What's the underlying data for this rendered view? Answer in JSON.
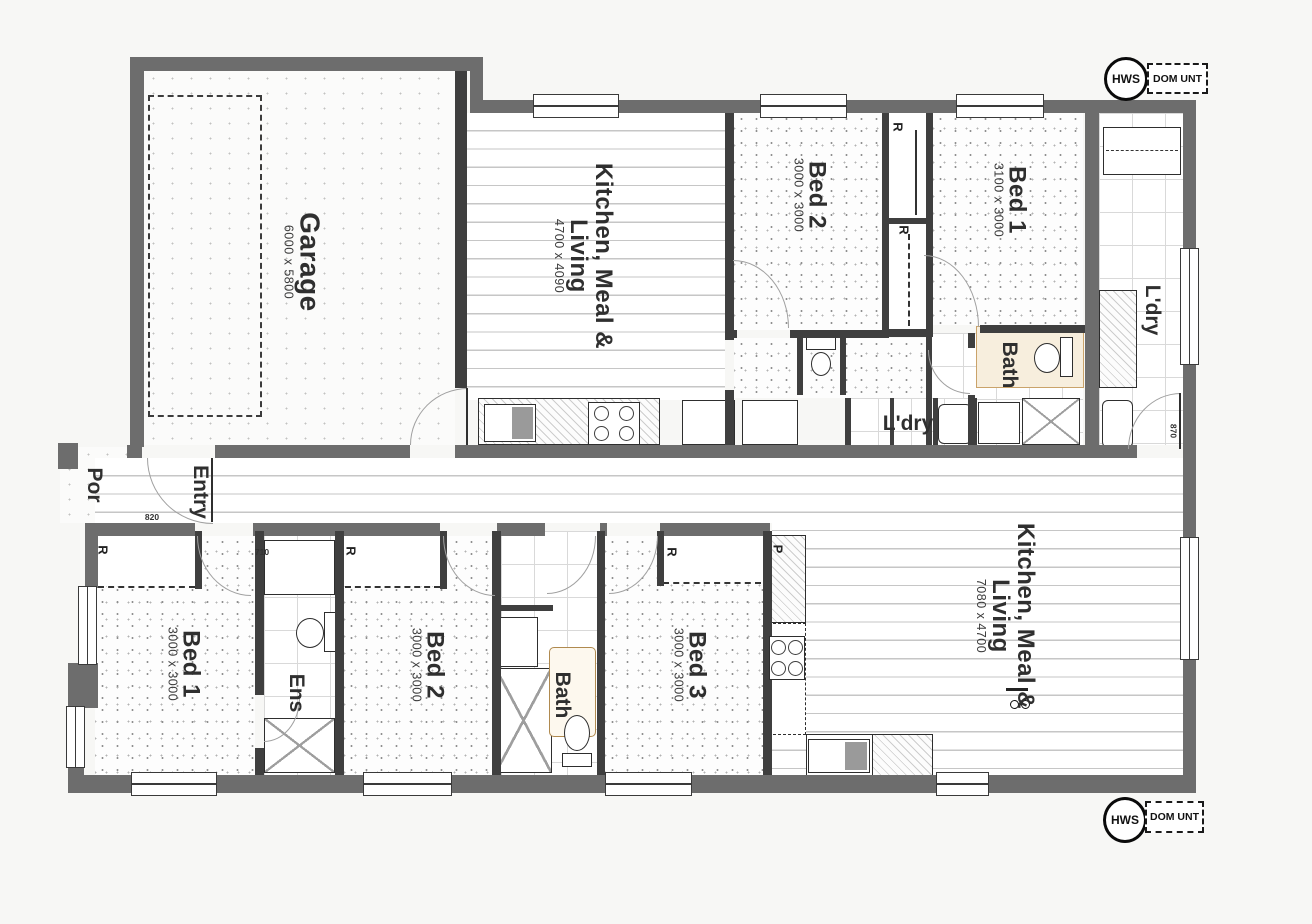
{
  "unit_a": {
    "garage": {
      "name": "Garage",
      "dims": "6000 x 5800"
    },
    "kitchen_meal_living": {
      "line1": "Kitchen, Meal &",
      "line2": "Living",
      "dims": "4700 x 4090"
    },
    "bed2": {
      "name": "Bed 2",
      "dims": "3000 x 3000"
    },
    "bed1": {
      "name": "Bed 1",
      "dims": "3100 x 3000"
    },
    "bath": {
      "name": "Bath"
    },
    "laundry": {
      "name": "L'dry"
    },
    "robe_bed2": "R",
    "robe_bed1": "R"
  },
  "unit_b": {
    "porch": {
      "name": "Por"
    },
    "entry": {
      "name": "Entry"
    },
    "bed1": {
      "name": "Bed 1",
      "dims": "3000 x 3000",
      "robe": "R"
    },
    "ensuite": {
      "name": "Ens"
    },
    "bed2": {
      "name": "Bed 2",
      "dims": "3000 x 3000",
      "robe": "R"
    },
    "bath": {
      "name": "Bath"
    },
    "bed3": {
      "name": "Bed 3",
      "dims": "3000 x 3000",
      "robe": "R"
    },
    "kitchen_meal_living": {
      "line1": "Kitchen, Meal &",
      "line2": "Living",
      "dims": "7080 x 4700"
    },
    "laundry": {
      "name": "L'dry"
    },
    "pantry": "P"
  },
  "services": {
    "hws_top": "HWS",
    "dom_unit_top": "DOM UNT",
    "hws_bottom": "HWS",
    "dom_unit_bottom": "DOM UNT"
  },
  "door_marks": {
    "entry": "820",
    "ensuite": "710",
    "laundry": "870"
  }
}
